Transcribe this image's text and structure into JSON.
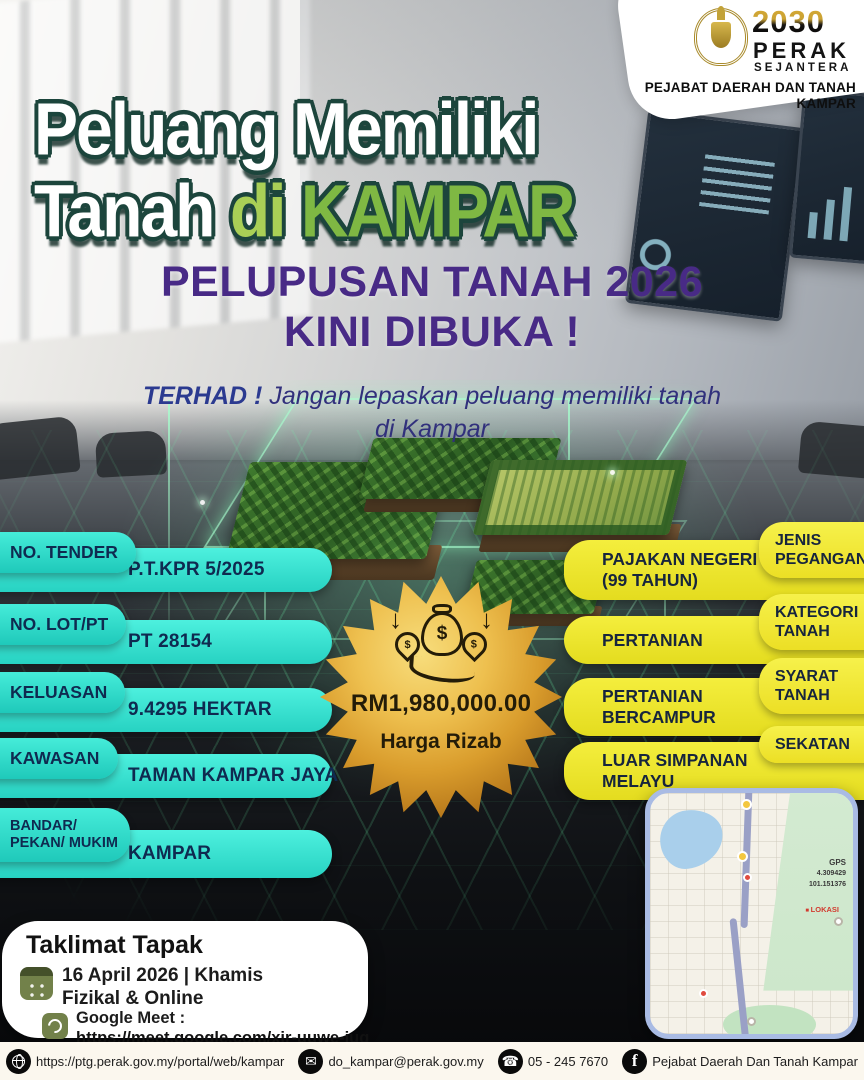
{
  "brand": {
    "logo_year": "2030",
    "logo_state": "PERAK",
    "logo_tagline": "SEJANTERA",
    "office_name": "PEJABAT DAERAH DAN TANAH KAMPAR"
  },
  "hero": {
    "title_line1": "Peluang Memiliki",
    "title_line2_white": "Tanah",
    "title_line2_green_di": "di",
    "title_line2_green_place": "KAMPAR",
    "headline_line1": "PELUPUSAN TANAH 2026",
    "headline_line2": "KINI DIBUKA !",
    "subheadline_bold": "TERHAD !",
    "subheadline_rest": "Jangan lepaskan peluang memiliki tanah",
    "subheadline_line2": "di Kampar"
  },
  "details_left": [
    {
      "label": "NO. TENDER",
      "value": "P.T.KPR 5/2025"
    },
    {
      "label": "NO. LOT/PT",
      "value": "PT 28154"
    },
    {
      "label": "KELUASAN",
      "value": "9.4295 HEKTAR"
    },
    {
      "label": "KAWASAN",
      "value": "TAMAN KAMPAR JAYA"
    },
    {
      "label": "BANDAR/ PEKAN/ MUKIM",
      "value": "KAMPAR"
    }
  ],
  "details_right": [
    {
      "label": "JENIS PEGANGAN",
      "value": "PAJAKAN NEGERI (99 TAHUN)"
    },
    {
      "label": "KATEGORI TANAH",
      "value": "PERTANIAN"
    },
    {
      "label": "SYARAT TANAH",
      "value": "PERTANIAN BERCAMPUR"
    },
    {
      "label": "SEKATAN",
      "value": "LUAR SIMPANAN MELAYU"
    }
  ],
  "price_badge": {
    "amount": "RM1,980,000.00",
    "caption": "Harga Rizab",
    "icon": "money-bags-in-hand-icon",
    "dollar": "$"
  },
  "briefing": {
    "title": "Taklimat Tapak",
    "date": "16 April 2026 | Khamis",
    "mode": "Fizikal & Online",
    "meet_label": "Google Meet :",
    "meet_link": "https://meet.google.com/xjr-uuwe-juq"
  },
  "map": {
    "gps_label": "GPS",
    "gps_lat": "4.309429",
    "gps_lng": "101.151376",
    "marker_label": "LOKASI"
  },
  "footer": {
    "website": "https://ptg.perak.gov.my/portal/web/kampar",
    "email": "do_kampar@perak.gov.my",
    "phone": "05 - 245 7670",
    "facebook": "Pejabat Daerah Dan Tanah Kampar",
    "facebook_initial": "f"
  },
  "colors": {
    "cyan_pill": "#35e6d3",
    "yellow_pill": "#f0e92f",
    "heading_purple": "#482a86",
    "pill_text_navy": "#0f2a50",
    "gold": "#d99c2c",
    "title_green": "#7fb843",
    "holo_green": "#8cffbe"
  }
}
